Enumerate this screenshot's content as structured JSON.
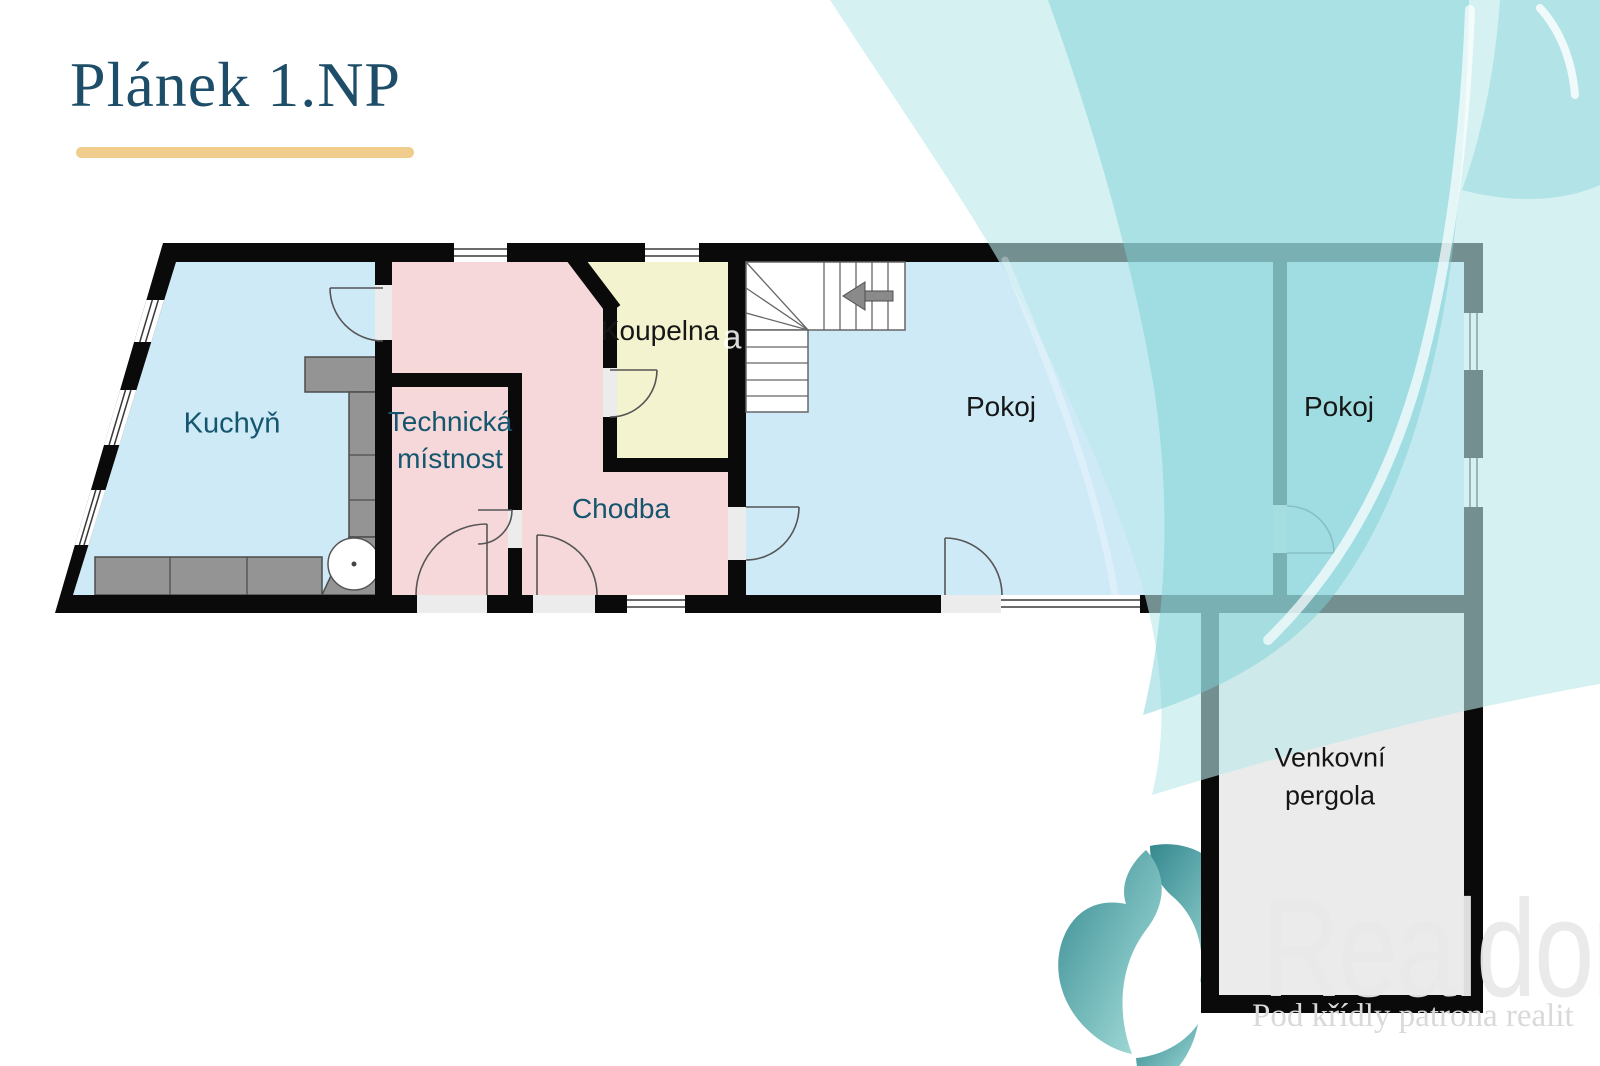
{
  "title": "Plánek 1.NP",
  "rooms": {
    "kuchyn": {
      "label": "Kuchyň"
    },
    "technicka": {
      "line1": "Technická",
      "line2": "místnost"
    },
    "koupelna": {
      "label": "Koupelna"
    },
    "chodba": {
      "label": "Chodba"
    },
    "pokoj1": {
      "label": "Pokoj"
    },
    "pokoj2": {
      "label": "Pokoj"
    },
    "pergola": {
      "line1": "Venkovní",
      "line2": "pergola"
    }
  },
  "watermark": {
    "stray_letter": "a",
    "brand": "Realdom",
    "tagline": "Pod křídly patrona realit"
  },
  "colors": {
    "gold": "#f0cd8d",
    "title": "#1d4d68",
    "label_teal": "#14566e",
    "label_dark": "#161616",
    "floor_blue": "#cfeaf7",
    "floor_pink": "#f7d8da",
    "floor_yellow": "#f4f3cf",
    "floor_gray": "#ebebeb",
    "wall": "#0a0a0a",
    "counter": "#949494",
    "watermark_teal": "#7ed2d8",
    "brand_teal": "#2e9097"
  }
}
